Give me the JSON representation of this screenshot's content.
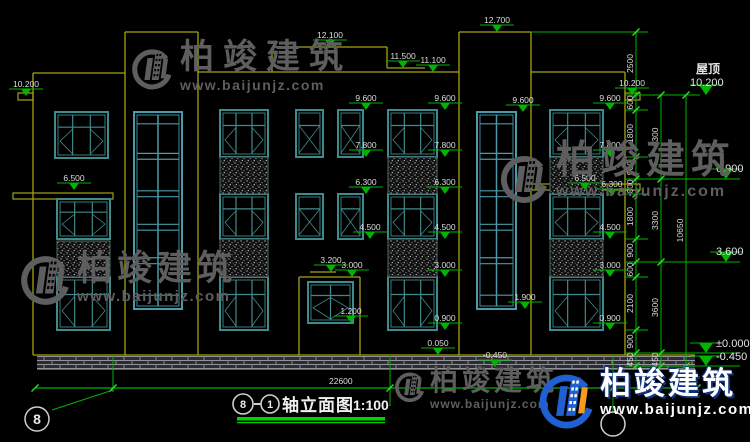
{
  "colors": {
    "bg": "#000000",
    "wall": "#a3a314",
    "wall_bright": "#b8b814",
    "window": "#3f8a8a",
    "window_tower": "#4a9aa8",
    "dim_green": "#00b400",
    "tick_green": "#2ae02a",
    "text_white": "#dcdcdc",
    "hatch_dot": "#9a9a9a",
    "brick_line": "#92929a",
    "underline_green": "#00d400",
    "bubble_stroke": "#cfcfcf",
    "logo_blue": "#2160d3",
    "logo_orange": "#f59b20"
  },
  "watermark": {
    "text": "柏竣建筑",
    "url": "www.baijunjz.com"
  },
  "roof_label": {
    "text": "屋顶"
  },
  "title": {
    "bubble_from": "8",
    "dash": "—",
    "bubble_to": "1",
    "name": "轴立面图",
    "scale": "1:100"
  },
  "drawing": {
    "walls": [
      [
        33,
        73,
        125,
        73
      ],
      [
        33,
        73,
        33,
        355
      ],
      [
        125,
        32,
        125,
        355
      ],
      [
        198,
        32,
        198,
        355
      ],
      [
        125,
        32,
        198,
        32
      ],
      [
        198,
        72,
        459,
        72
      ],
      [
        272,
        47,
        387,
        47
      ],
      [
        272,
        47,
        272,
        72
      ],
      [
        387,
        47,
        387,
        68
      ],
      [
        387,
        68,
        425,
        68
      ],
      [
        459,
        32,
        459,
        355
      ],
      [
        531,
        32,
        531,
        355
      ],
      [
        459,
        32,
        531,
        32
      ],
      [
        531,
        72,
        625,
        72
      ],
      [
        625,
        72,
        625,
        355
      ],
      [
        33,
        355,
        695,
        355
      ],
      [
        37,
        369,
        695,
        369
      ],
      [
        299,
        277,
        299,
        355
      ],
      [
        360,
        277,
        360,
        355
      ],
      [
        299,
        277,
        360,
        277
      ],
      [
        310,
        272,
        336,
        272
      ]
    ],
    "tabs": [
      [
        18,
        93,
        15,
        7
      ],
      [
        625,
        93,
        15,
        7
      ],
      [
        13,
        193,
        100,
        6
      ],
      [
        532,
        184,
        108,
        6
      ]
    ],
    "plinth": [
      37,
      356,
      658,
      13
    ],
    "windows": [
      [
        55,
        112,
        53,
        46,
        "w3"
      ],
      [
        57,
        199,
        53,
        40,
        "w3"
      ],
      [
        57,
        277,
        53,
        53,
        "w3"
      ],
      [
        134,
        112,
        48,
        197,
        "tw"
      ],
      [
        220,
        110,
        48,
        47,
        "w3"
      ],
      [
        220,
        194,
        48,
        45,
        "w3"
      ],
      [
        220,
        277,
        48,
        53,
        "w3"
      ],
      [
        296,
        110,
        27,
        47,
        "w2"
      ],
      [
        296,
        194,
        27,
        45,
        "w2"
      ],
      [
        338,
        110,
        25,
        47,
        "w2"
      ],
      [
        338,
        194,
        25,
        45,
        "w2"
      ],
      [
        308,
        282,
        45,
        41,
        "p2"
      ],
      [
        388,
        110,
        49,
        47,
        "w3"
      ],
      [
        388,
        194,
        49,
        45,
        "w3"
      ],
      [
        388,
        277,
        49,
        53,
        "w3"
      ],
      [
        477,
        112,
        39,
        197,
        "tw"
      ],
      [
        550,
        110,
        53,
        47,
        "w3"
      ],
      [
        550,
        194,
        53,
        45,
        "w3"
      ],
      [
        550,
        277,
        53,
        53,
        "w3"
      ]
    ],
    "hatches": [
      [
        220,
        157,
        48,
        37
      ],
      [
        220,
        239,
        48,
        38
      ],
      [
        388,
        157,
        49,
        37
      ],
      [
        388,
        239,
        49,
        38
      ],
      [
        550,
        157,
        53,
        37
      ],
      [
        550,
        239,
        53,
        38
      ],
      [
        57,
        241,
        53,
        36
      ]
    ],
    "markers": [
      [
        "10.200",
        26,
        96
      ],
      [
        "6.500",
        74,
        190
      ],
      [
        "12.100",
        330,
        47
      ],
      [
        "11.500",
        403,
        68
      ],
      [
        "11.100",
        433,
        72
      ],
      [
        "12.700",
        497,
        32
      ],
      [
        "9.600",
        366,
        110
      ],
      [
        "7.800",
        366,
        157
      ],
      [
        "6.300",
        366,
        194
      ],
      [
        "4.500",
        370,
        239
      ],
      [
        "3.200",
        331,
        272
      ],
      [
        "3.000",
        352,
        277
      ],
      [
        "1.200",
        351,
        323
      ],
      [
        "9.600",
        445,
        110
      ],
      [
        "7.800",
        445,
        157
      ],
      [
        "6.300",
        445,
        194
      ],
      [
        "4.500",
        445,
        239
      ],
      [
        "3.000",
        445,
        277
      ],
      [
        "0.900",
        445,
        330
      ],
      [
        "0.050",
        438,
        355
      ],
      [
        "9.600",
        523,
        112
      ],
      [
        "1.900",
        525,
        309
      ],
      [
        "-0.450",
        495,
        367
      ],
      [
        "9.600",
        610,
        110
      ],
      [
        "7.800",
        610,
        157
      ],
      [
        "6.500",
        585,
        190
      ],
      [
        "6.300",
        612,
        196
      ],
      [
        "4.500",
        610,
        239
      ],
      [
        "3.000",
        610,
        277
      ],
      [
        "0.900",
        610,
        330
      ],
      [
        "10.200",
        632,
        95
      ]
    ],
    "big_markers": [
      [
        "10.200",
        706,
        95,
        690,
        86
      ],
      [
        "6.900",
        726,
        179,
        716,
        172
      ],
      [
        "3.600",
        726,
        262,
        716,
        255
      ],
      [
        "±0.000",
        706,
        353,
        716,
        347
      ],
      [
        "-0.450",
        706,
        366,
        716,
        360
      ]
    ],
    "roof_label_pos": [
      696,
      73
    ],
    "chains": [
      {
        "x": 636,
        "ys": [
          32,
          95,
          110,
          157,
          179,
          194,
          239,
          262,
          277,
          330,
          353,
          366
        ],
        "labels": [
          "2500",
          "600",
          "1800",
          "900",
          "600",
          "1800",
          "900",
          "600",
          "2100",
          "900",
          "450"
        ]
      },
      {
        "x": 661,
        "ys": [
          95,
          179,
          262,
          353,
          366
        ],
        "labels": [
          "3300",
          "3300",
          "3600",
          "450"
        ]
      },
      {
        "x": 686,
        "ys": [
          95,
          366
        ],
        "labels": [
          "10650"
        ]
      }
    ],
    "ext_lines": [
      [
        531,
        32,
        648,
        32
      ],
      [
        625,
        95,
        700,
        95
      ],
      [
        625,
        110,
        648,
        110
      ],
      [
        625,
        157,
        648,
        157
      ],
      [
        625,
        179,
        740,
        179
      ],
      [
        625,
        194,
        648,
        194
      ],
      [
        625,
        239,
        648,
        239
      ],
      [
        625,
        262,
        740,
        262
      ],
      [
        625,
        277,
        648,
        277
      ],
      [
        625,
        330,
        648,
        330
      ],
      [
        625,
        353,
        740,
        353
      ],
      [
        625,
        366,
        740,
        366
      ]
    ],
    "verticals": [
      [
        113,
        355,
        113,
        392
      ],
      [
        390,
        355,
        390,
        406
      ],
      [
        613,
        355,
        613,
        412
      ]
    ],
    "leader": [
      113,
      390,
      52,
      410
    ],
    "dim_line": {
      "y": 388,
      "x1": 35,
      "x2": 697,
      "ticks": [
        35,
        113,
        390,
        613,
        697
      ],
      "label": "22600",
      "lx": 329,
      "ly": 384
    },
    "bubbles": [
      {
        "x": 37,
        "y": 419,
        "r": 12,
        "label": "8"
      },
      {
        "x": 613,
        "y": 424,
        "r": 12,
        "label": ""
      }
    ],
    "underline": [
      [
        237,
        417,
        148,
        3.5
      ],
      [
        237,
        422,
        148,
        1.2
      ]
    ]
  }
}
